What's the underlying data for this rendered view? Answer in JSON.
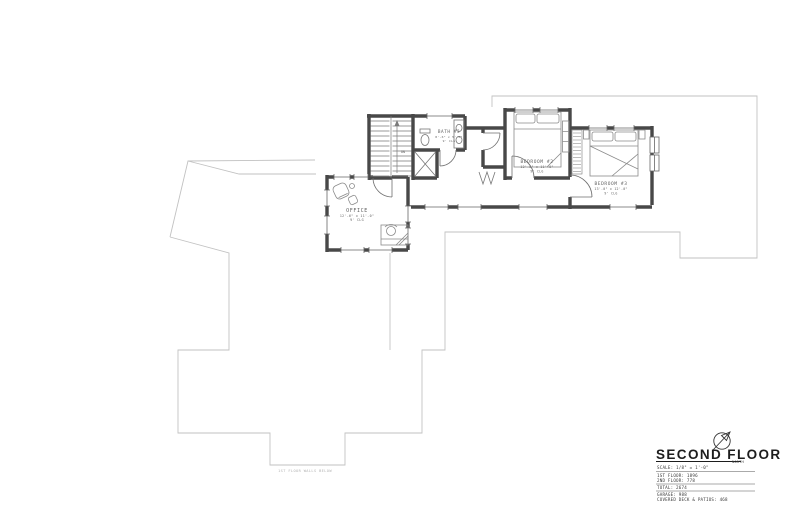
{
  "drawing": {
    "title": "SECOND FLOOR",
    "north_label": "NORTH",
    "scale_line": "SCALE: 1/8\" = 1'-0\"",
    "stats": [
      "1ST FLOOR: 1896",
      "2ND FLOOR: 778",
      "TOTAL: 2674",
      "GARAGE: 988",
      "COVERED DECK & PATIOS: 468"
    ],
    "walls_below_note": "1ST FLOOR WALLS BELOW",
    "colors": {
      "walls": "#484848",
      "below_outline": "#c2c2c2",
      "window_line": "#666666",
      "furniture": "#8a8a8a",
      "label_text": "#5f5f5f"
    }
  },
  "rooms": {
    "office": {
      "name": "OFFICE",
      "dims": "12'-6\" x 11'-0\"",
      "ceiling": "9' CLG"
    },
    "bath3": {
      "name": "BATH #3",
      "dims": "8'-6\" x 5'-0\"",
      "ceiling": "9' CLG"
    },
    "bedroom2": {
      "name": "BEDROOM #2",
      "dims": "12'-0\" x 11'-0\"",
      "ceiling": "9' CLG"
    },
    "bedroom3": {
      "name": "BEDROOM #3",
      "dims": "13'-0\" x 12'-0\"",
      "ceiling": "9' CLG"
    },
    "stairs": {
      "down_label": "DN"
    }
  }
}
